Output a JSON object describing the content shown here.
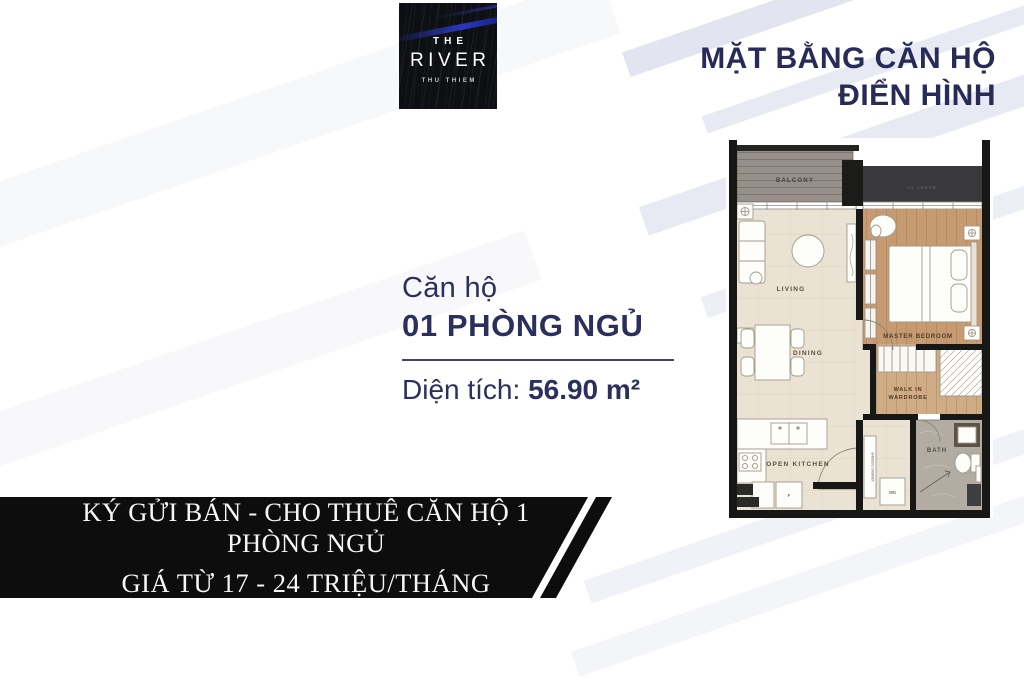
{
  "logo": {
    "line1": "THE",
    "line2": "RIVER",
    "line3": "THU THIEM"
  },
  "header": {
    "title_line1": "MẶT BẰNG CĂN HỘ",
    "title_line2": "ĐIỂN HÌNH"
  },
  "apartment": {
    "label": "Căn hộ",
    "name": "01 PHÒNG NGỦ",
    "area_label": "Diện tích:",
    "area_value": "56.90 m²"
  },
  "floorplan": {
    "rooms": {
      "balcony": "BALCONY",
      "living": "LIVING",
      "dining": "DINING",
      "master_bedroom": "MASTER BEDROOM",
      "wardrobe_line1": "WALK IN",
      "wardrobe_line2": "WARDROBE",
      "open_kitchen": "OPEN KITCHEN",
      "bath": "BATH",
      "ac_ledge": "AC LEDGE"
    },
    "fixtures": {
      "fridge": "F",
      "washer": "WD",
      "shoe_cabinet": "SHOE/DC CABINET"
    }
  },
  "banner": {
    "line1": "KÝ GỬI  BÁN - CHO THUÊ CĂN HỘ 1 PHÒNG NGỦ",
    "line2": "GIÁ TỪ 17 - 24 TRIỆU/THÁNG"
  },
  "colors": {
    "navy": "#282b57",
    "banner_black": "#0d0d0e",
    "beige_floor": "#eae3d3",
    "wood_floor": "#c69b72",
    "wardrobe_floor": "#cfac83",
    "bath_floor": "#b3aca3",
    "balcony_floor": "#97908a",
    "stripe_blue": "#e2e5f0",
    "logo_blue": "#2b3ac9"
  }
}
